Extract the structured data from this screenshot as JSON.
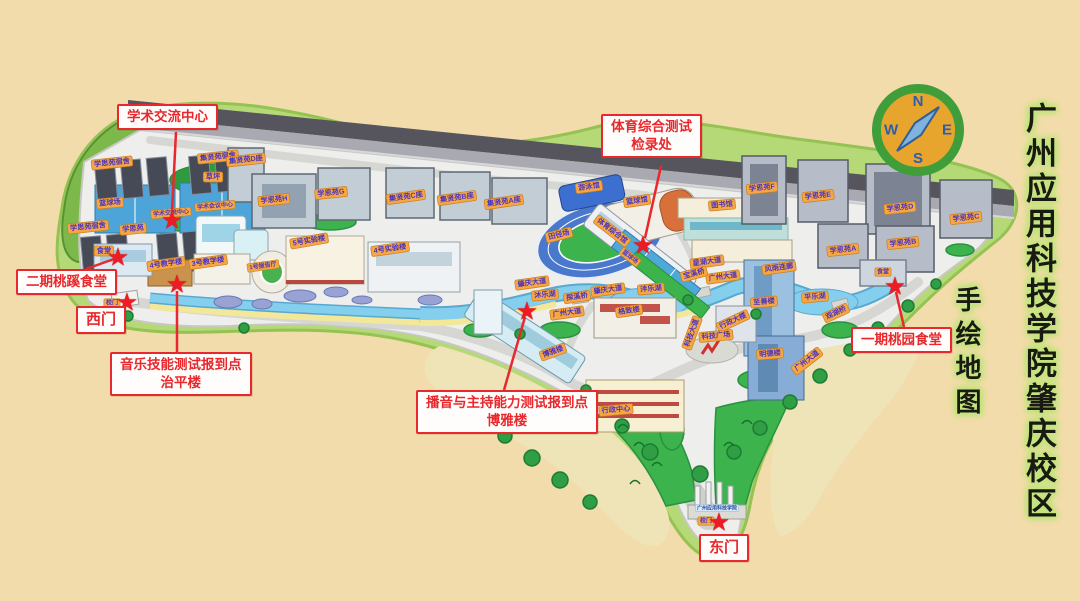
{
  "title": {
    "main": "广州应用科技学院肇庆校区",
    "sub": "手绘地图"
  },
  "compass": {
    "north": "N",
    "south": "S",
    "east": "E",
    "west": "W"
  },
  "colors": {
    "callout_red": "#e8282c",
    "label_orange": "#f6a644",
    "label_text_blue": "#4a35c2",
    "map_green": "#b6d977",
    "water_blue": "#85cfee",
    "sand_beige": "#f2dcab"
  },
  "callouts": {
    "academic_exchange": {
      "text": "学术交流中心"
    },
    "sports_test": {
      "line1": "体育综合测试",
      "line2": "检录处"
    },
    "canteen_phase2": {
      "text": "二期桃蹊食堂"
    },
    "west_gate": {
      "text": "西门"
    },
    "music_test": {
      "line1": "音乐技能测试报到点",
      "line2": "治平楼"
    },
    "broadcast_test": {
      "line1": "播音与主持能力测试报到点",
      "line2": "博雅楼"
    },
    "east_gate": {
      "text": "东门"
    },
    "canteen_phase1": {
      "text": "一期桃园食堂"
    }
  },
  "map_labels": [
    {
      "id": "xs_dorm_nw",
      "text": "学思苑宿舍"
    },
    {
      "id": "jx_dorm_ne",
      "text": "集贤苑宿舍"
    },
    {
      "id": "xs_dorm_sw",
      "text": "学思苑宿舍"
    },
    {
      "id": "xs_dorm_s",
      "text": "学思苑"
    },
    {
      "id": "canteen_w_chip",
      "text": "食堂"
    },
    {
      "id": "bball_w",
      "text": "篮球场"
    },
    {
      "id": "lawn",
      "text": "草坪"
    },
    {
      "id": "jx_d",
      "text": "集贤苑D座"
    },
    {
      "id": "xs_h",
      "text": "学思苑H"
    },
    {
      "id": "xs_g",
      "text": "学思苑G"
    },
    {
      "id": "jx_c",
      "text": "集贤苑C座"
    },
    {
      "id": "jx_b",
      "text": "集贤苑B座"
    },
    {
      "id": "jx_a",
      "text": "集贤苑A座"
    },
    {
      "id": "acad_exchange_chip",
      "text": "学术交流中心"
    },
    {
      "id": "acad_conference_chip",
      "text": "学术会议中心"
    },
    {
      "id": "teach4",
      "text": "4号教学楼"
    },
    {
      "id": "teach3",
      "text": "3号教学楼"
    },
    {
      "id": "hall1",
      "text": "1号报告厅"
    },
    {
      "id": "lab5",
      "text": "5号实验楼"
    },
    {
      "id": "lab4",
      "text": "4号实验楼"
    },
    {
      "id": "gate_w_chip",
      "text": "校门"
    },
    {
      "id": "swim",
      "text": "游泳馆"
    },
    {
      "id": "bball_hall",
      "text": "篮球馆"
    },
    {
      "id": "track",
      "text": "田径场"
    },
    {
      "id": "sports_hall",
      "text": "体育综合馆"
    },
    {
      "id": "bball_center",
      "text": "篮球场"
    },
    {
      "id": "library",
      "text": "图书馆"
    },
    {
      "id": "xs_f",
      "text": "学思苑F"
    },
    {
      "id": "xs_e",
      "text": "学思苑E"
    },
    {
      "id": "xs_d",
      "text": "学思苑D"
    },
    {
      "id": "xs_c",
      "text": "学思苑C"
    },
    {
      "id": "xs_b",
      "text": "学思苑B"
    },
    {
      "id": "xs_a",
      "text": "学思苑A"
    },
    {
      "id": "canteen_e_chip",
      "text": "食堂"
    },
    {
      "id": "corridor",
      "text": "风雨连廊"
    },
    {
      "id": "lake_ping",
      "text": "平乐湖"
    },
    {
      "id": "bridge_guanhu",
      "text": "观湖桥"
    },
    {
      "id": "gz_ave_3",
      "text": "广州大道"
    },
    {
      "id": "gz_ave_2",
      "text": "广州大道"
    },
    {
      "id": "gz_ave_1",
      "text": "广州大道"
    },
    {
      "id": "zq_ave_1",
      "text": "肇庆大道"
    },
    {
      "id": "zq_ave_2",
      "text": "肇庆大道"
    },
    {
      "id": "xinghu_ave",
      "text": "星湖大道"
    },
    {
      "id": "bridge_baoxi",
      "text": "宝溪桥"
    },
    {
      "id": "bridge_tanxi",
      "text": "探溪桥"
    },
    {
      "id": "lake_mu",
      "text": "沐乐湖"
    },
    {
      "id": "lake_pan",
      "text": "泮乐湖"
    },
    {
      "id": "boya",
      "text": "博雅楼"
    },
    {
      "id": "admin_center",
      "text": "行政中心"
    },
    {
      "id": "gezhi",
      "text": "格致楼"
    },
    {
      "id": "admin_building",
      "text": "行政大楼"
    },
    {
      "id": "tech_square",
      "text": "科技广场"
    },
    {
      "id": "tech_ave",
      "text": "科技大道"
    },
    {
      "id": "zhishan",
      "text": "至善楼"
    },
    {
      "id": "mingde",
      "text": "明德楼"
    },
    {
      "id": "gate_e_chip",
      "text": "校门"
    },
    {
      "id": "gate_sign",
      "text": "广州应用科技学院"
    }
  ]
}
